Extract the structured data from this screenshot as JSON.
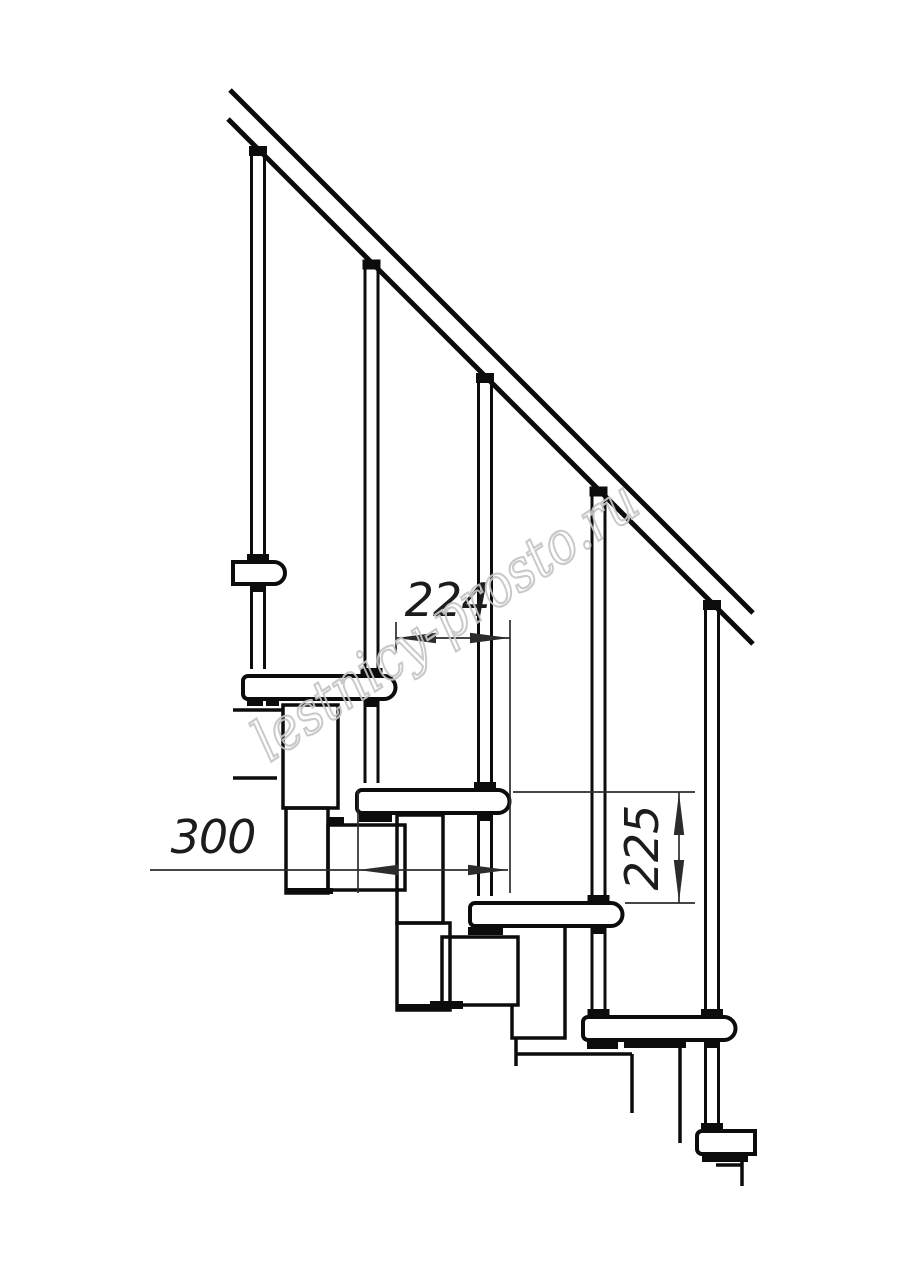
{
  "page": {
    "background_color": "#ffffff"
  },
  "drawing": {
    "kind": "staircase-side-elevation-line-drawing",
    "ink_color": "#0c0c0c",
    "dim_color": "#2c2c2c",
    "dim_text_color": "#1c1c1c",
    "dimensions": {
      "run": "224",
      "tread_length": "300",
      "rise": "225"
    },
    "watermark": {
      "text": "lestnicy-prosto.ru",
      "color": "#c5c5c5"
    }
  }
}
